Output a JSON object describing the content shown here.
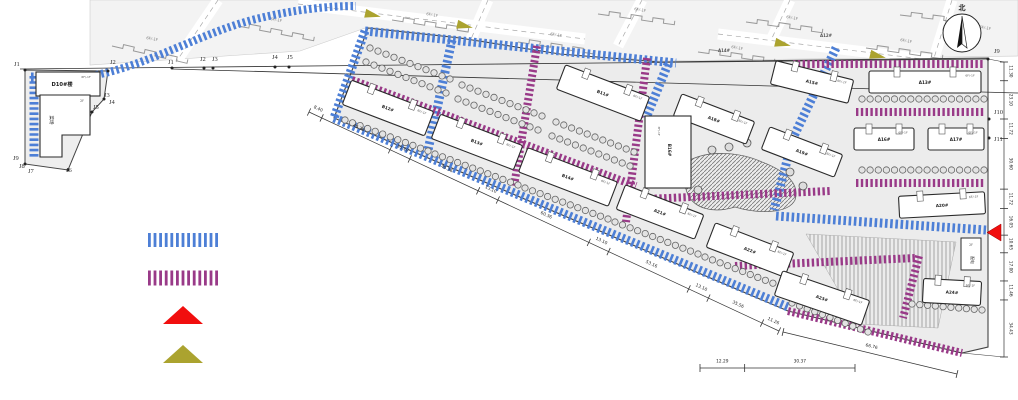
{
  "colors": {
    "road_blue": "#4d7fd6",
    "road_purple": "#993a88",
    "arrow_red": "#f10e0e",
    "arrow_olive": "#aba32f",
    "parcel_fill": "#f3f3f3",
    "site_fill": "#ececec",
    "outline": "#444444"
  },
  "compass": {
    "north_label": "北"
  },
  "legend": {
    "items": [
      {
        "symbol": "blue-hatch-road"
      },
      {
        "symbol": "purple-hatch-road"
      },
      {
        "symbol": "red-entrance-arrow"
      },
      {
        "symbol": "olive-flow-arrow"
      }
    ]
  },
  "plan": {
    "buildings": [
      {
        "label": "B12#",
        "floors": "6F/-1F"
      },
      {
        "label": "B13#",
        "floors": "6F/-1F"
      },
      {
        "label": "B14#",
        "floors": "6F/-1F"
      },
      {
        "label": "B11#",
        "floors": "6F/-1F"
      },
      {
        "label": "A21#",
        "floors": "6F/-1F"
      },
      {
        "label": "A22#",
        "floors": "6F/-1F"
      },
      {
        "label": "A23#",
        "floors": "6F/-1F"
      },
      {
        "label": "A24#",
        "floors": "6F/-1F"
      },
      {
        "label": "A18#",
        "floors": "6F/-1F"
      },
      {
        "label": "A19#",
        "floors": "6F/-1F"
      },
      {
        "label": "A15#",
        "floors": "6F/-1F"
      },
      {
        "label": "A13#",
        "floors": "6F/-1F"
      },
      {
        "label": "A16#",
        "floors": "6F/-1F"
      },
      {
        "label": "A17#",
        "floors": "6F/-1F"
      },
      {
        "label": "A20#",
        "floors": "6F/-1F"
      }
    ],
    "special": {
      "d10": {
        "label": "D10#楼",
        "floors": "6F/-1F"
      },
      "market": {
        "label": "菜场",
        "floors": "2F"
      },
      "b16": {
        "label": "B16#",
        "floors": "3F/-1F"
      },
      "power": {
        "label": "配电",
        "floors": "2F"
      }
    },
    "survey_points_left": [
      "J1",
      "J2",
      "J3",
      "J4",
      "J5",
      "J6",
      "J7",
      "J8",
      "J9"
    ],
    "survey_points_top": [
      "J1",
      "J2",
      "J3",
      "J4",
      "J5"
    ],
    "survey_points_right": [
      "J9",
      "J10",
      "J11"
    ]
  },
  "top_strip": {
    "floors_note": "6F/-1F",
    "building_labels": [
      "A12#",
      "A14#"
    ]
  },
  "dims": {
    "south": [
      "8.40",
      "45.36",
      "13.10",
      "45.36",
      "13.10",
      "60.36",
      "13.10",
      "53.16",
      "13.10",
      "35.56",
      "11.26"
    ],
    "southeast": [
      "66.76"
    ],
    "bottom": [
      "12.29",
      "30.37"
    ],
    "right": [
      "11.30",
      "23.10",
      "11.72",
      "30.60",
      "11.72",
      "16.05",
      "10.65",
      "17.00",
      "11.46",
      "34.43"
    ]
  }
}
